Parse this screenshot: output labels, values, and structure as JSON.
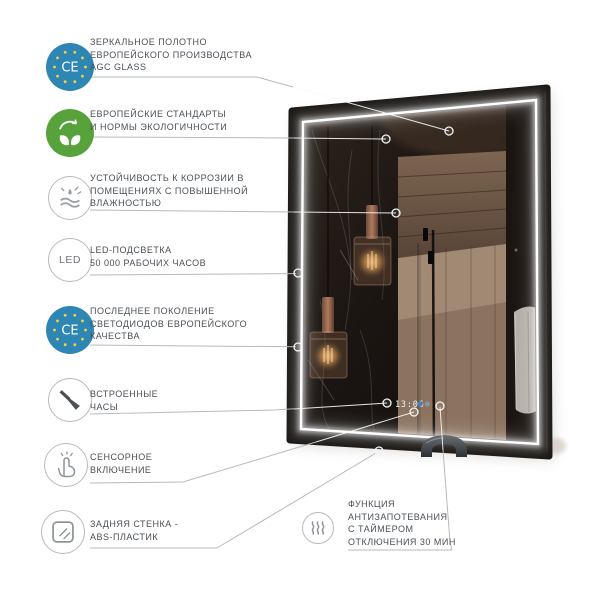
{
  "product": {
    "type": "led-bathroom-mirror-infographic",
    "clock_display": "13:06"
  },
  "colors": {
    "accent_blue": "#2e86b4",
    "accent_green": "#57a23a",
    "star_yellow": "#f4d43c",
    "text_gray": "#4a5056",
    "line_gray": "#b5bac0",
    "led_glow_white": "#ffffff",
    "frame_dark": "#15120f",
    "lamp_amber": "#ffc97f"
  },
  "features": [
    {
      "id": "mirror-glass",
      "icon": "ce-euro-icon",
      "lines": [
        "ЗЕРКАЛЬНОЕ ПОЛОТНО",
        "ЕВРОПЕЙСКОГО ПРОИЗВОДСТВА",
        "AGC GLASS"
      ]
    },
    {
      "id": "eco-standards",
      "icon": "eco-leaves-icon",
      "lines": [
        "ЕВРОПЕЙСКИЕ СТАНДАРТЫ",
        "И НОРМЫ ЭКОЛОГИЧНОСТИ"
      ]
    },
    {
      "id": "corrosion-resistance",
      "icon": "water-resist-icon",
      "lines": [
        "УСТОЙЧИВОСТЬ К КОРРОЗИИ В",
        "ПОМЕЩЕНИЯХ С ПОВЫШЕННОЙ",
        "ВЛАЖНОСТЬЮ"
      ]
    },
    {
      "id": "led-backlight",
      "icon": "led-text-icon",
      "icon_label": "LED",
      "lines": [
        "LED-ПОДСВЕТКА",
        "50 000 РАБОЧИХ ЧАСОВ"
      ]
    },
    {
      "id": "led-diodes-quality",
      "icon": "ce-euro-icon",
      "lines": [
        "ПОСЛЕДНЕЕ ПОКОЛЕНИЕ",
        "СВЕТОДИОДОВ ЕВРОПЕЙСКОГО",
        "КАЧЕСТВА"
      ]
    },
    {
      "id": "built-in-clock",
      "icon": "clock-icon",
      "lines": [
        "ВСТРОЕННЫЕ",
        "ЧАСЫ"
      ]
    },
    {
      "id": "touch-switch",
      "icon": "touch-icon",
      "lines": [
        "СЕНСОРНОЕ",
        "ВКЛЮЧЕНИЕ"
      ]
    },
    {
      "id": "back-panel",
      "icon": "abs-panel-icon",
      "lines": [
        "ЗАДНЯЯ СТЕНКА -",
        "ABS-ПЛАСТИК"
      ]
    },
    {
      "id": "antifog",
      "icon": "steam-icon",
      "lines": [
        "ФУНКЦИЯ",
        "АНТИЗАПОТЕВАНИЯ",
        "С ТАЙМЕРОМ",
        "ОТКЛЮЧЕНИЯ 30 МИН"
      ]
    }
  ]
}
